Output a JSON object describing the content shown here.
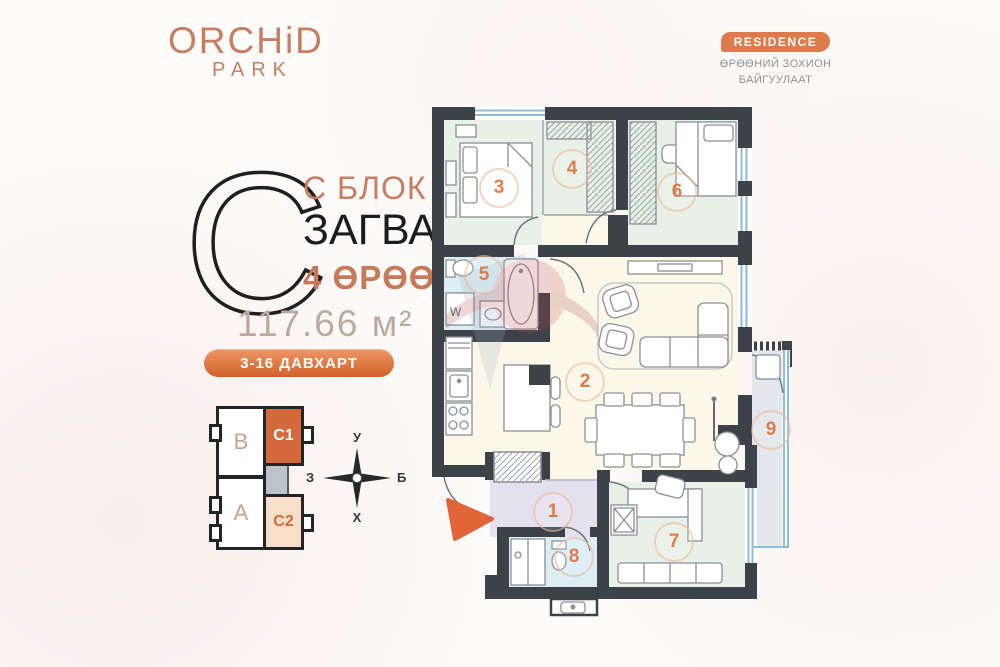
{
  "colors": {
    "accent_orange": "#d2612a",
    "badge_orange": "#dd7b4d",
    "terracotta": "#c57e60",
    "wall_dark": "#3b4248",
    "room_green": "#e7f1e7",
    "room_blue": "#dcedf4",
    "room_cream": "#fbf8e9",
    "room_lavender": "#e4e1ee",
    "balcony_gray": "#e3e6ea",
    "window_blue": "#8bbdd6",
    "number_orange": "#dd7d4e"
  },
  "logo": {
    "title": "ORCHiD",
    "subtitle": "PARK"
  },
  "residence": {
    "badge": "RESIDENCE",
    "subtitle_line1": "ӨРӨӨНИЙ ЗОХИОН",
    "subtitle_line2": "БАЙГУУЛААТ"
  },
  "unit": {
    "letter": "C",
    "block_label": "С БЛОК",
    "model_label": "ЗАГВАР",
    "rooms_label": "4 ӨРӨӨ",
    "area": "117.66 м²",
    "floors_badge": "3-16 ДАВХАРТ"
  },
  "mini_map": {
    "units": [
      {
        "label": "B"
      },
      {
        "label": "C1"
      },
      {
        "label": "A"
      },
      {
        "label": "C2"
      }
    ]
  },
  "compass": {
    "north": "У",
    "south": "Х",
    "west": "З",
    "east": "Б"
  },
  "plan": {
    "room_numbers": [
      "1",
      "2",
      "3",
      "4",
      "5",
      "6",
      "7",
      "8",
      "9"
    ],
    "washer_label": "W"
  }
}
